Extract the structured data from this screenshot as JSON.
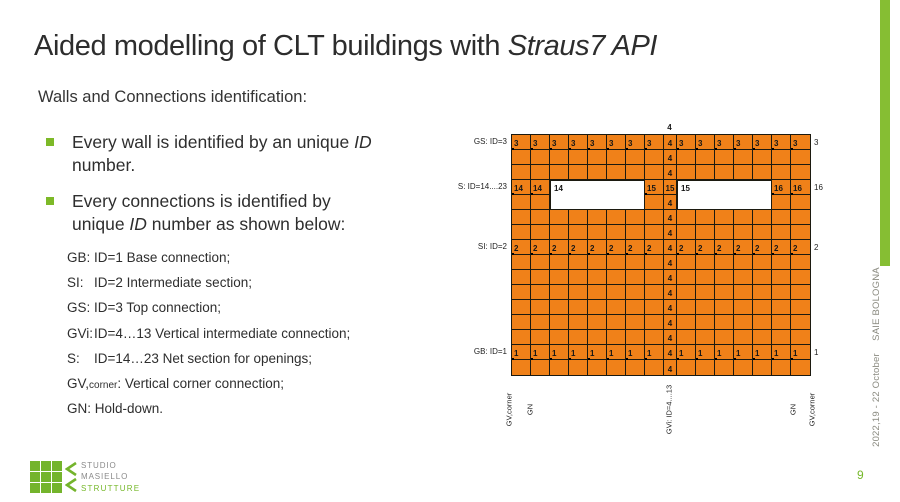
{
  "slide": {
    "title": {
      "pre": "Aided modelling of CLT buildings with ",
      "italic": "Straus7 API"
    },
    "subtitle": "Walls and Connections identification:",
    "bullets": [
      {
        "line1_pre": "Every wall is identified by an unique ",
        "line1_italic": "ID",
        "line2": "number."
      },
      {
        "line1": "Every connections is identified by",
        "line2_pre": "unique ",
        "line2_italic": "ID",
        "line2_post": " number as shown below:"
      }
    ]
  },
  "connections": {
    "items": [
      {
        "key": "GB:",
        "text": "ID=1 Base connection;"
      },
      {
        "key": "SI:",
        "text": "ID=2 Intermediate section;"
      },
      {
        "key": "GS:",
        "text": "ID=3 Top connection;"
      },
      {
        "key": "GVi:",
        "text": "ID=4…13 Vertical intermediate connection;"
      },
      {
        "key": "S:",
        "text": "ID=14…23 Net section for openings;"
      },
      {
        "main": "GV,",
        "sub": "corner",
        "rest": ": Vertical corner connection;"
      },
      {
        "text": "GN: Hold-down."
      }
    ]
  },
  "diagram": {
    "rows": 16,
    "cols": 16,
    "top_connection_label": "4",
    "mid_col": {
      "index": 9,
      "default_value": "4",
      "opening_row_value": "15"
    },
    "row_values": {
      "1": "3",
      "8": "2",
      "15": "1"
    },
    "opening_row": {
      "index": 4,
      "cells": {
        "1": "14",
        "2": "14",
        "8": "15",
        "15": "16",
        "16": "16"
      }
    },
    "openings": [
      {
        "label": "14",
        "col_start": 3,
        "cols": 5,
        "row_start": 4,
        "rows": 2
      },
      {
        "label": "15",
        "col_start": 10,
        "cols": 5,
        "row_start": 4,
        "rows": 2
      }
    ],
    "left_labels": [
      {
        "text": "GS: ID=3",
        "row": 1
      },
      {
        "text": "S: ID=14....23",
        "row": 4
      },
      {
        "text": "SI: ID=2",
        "row": 8
      },
      {
        "text": "GB: ID=1",
        "row": 15
      }
    ],
    "right_edge_labels": [
      {
        "text": "3",
        "row": 1
      },
      {
        "text": "16",
        "row": 4
      },
      {
        "text": "2",
        "row": 8
      },
      {
        "text": "1",
        "row": 15
      }
    ],
    "bottom_labels": [
      {
        "text": "GV,corner",
        "cx": -2
      },
      {
        "text": "GN",
        "cx": 19
      },
      {
        "text": "GVi: ID=4....13",
        "cx": 158
      },
      {
        "text": "GN",
        "cx": 282
      },
      {
        "text": "GV,corner",
        "cx": 301
      }
    ],
    "colors": {
      "wall_fill": "#F08119",
      "grid_line": "#1C1A10"
    }
  },
  "sidebar": {
    "event_name": "SAIE BOLOGNA",
    "event_date": "2022,19 - 22 October",
    "bar_color": "#86BE33",
    "page_number": "9"
  },
  "logo": {
    "line1": "STUDIO",
    "line2": "MASIELLO",
    "line3": "STRUTTURE",
    "green": "#76B82A"
  }
}
